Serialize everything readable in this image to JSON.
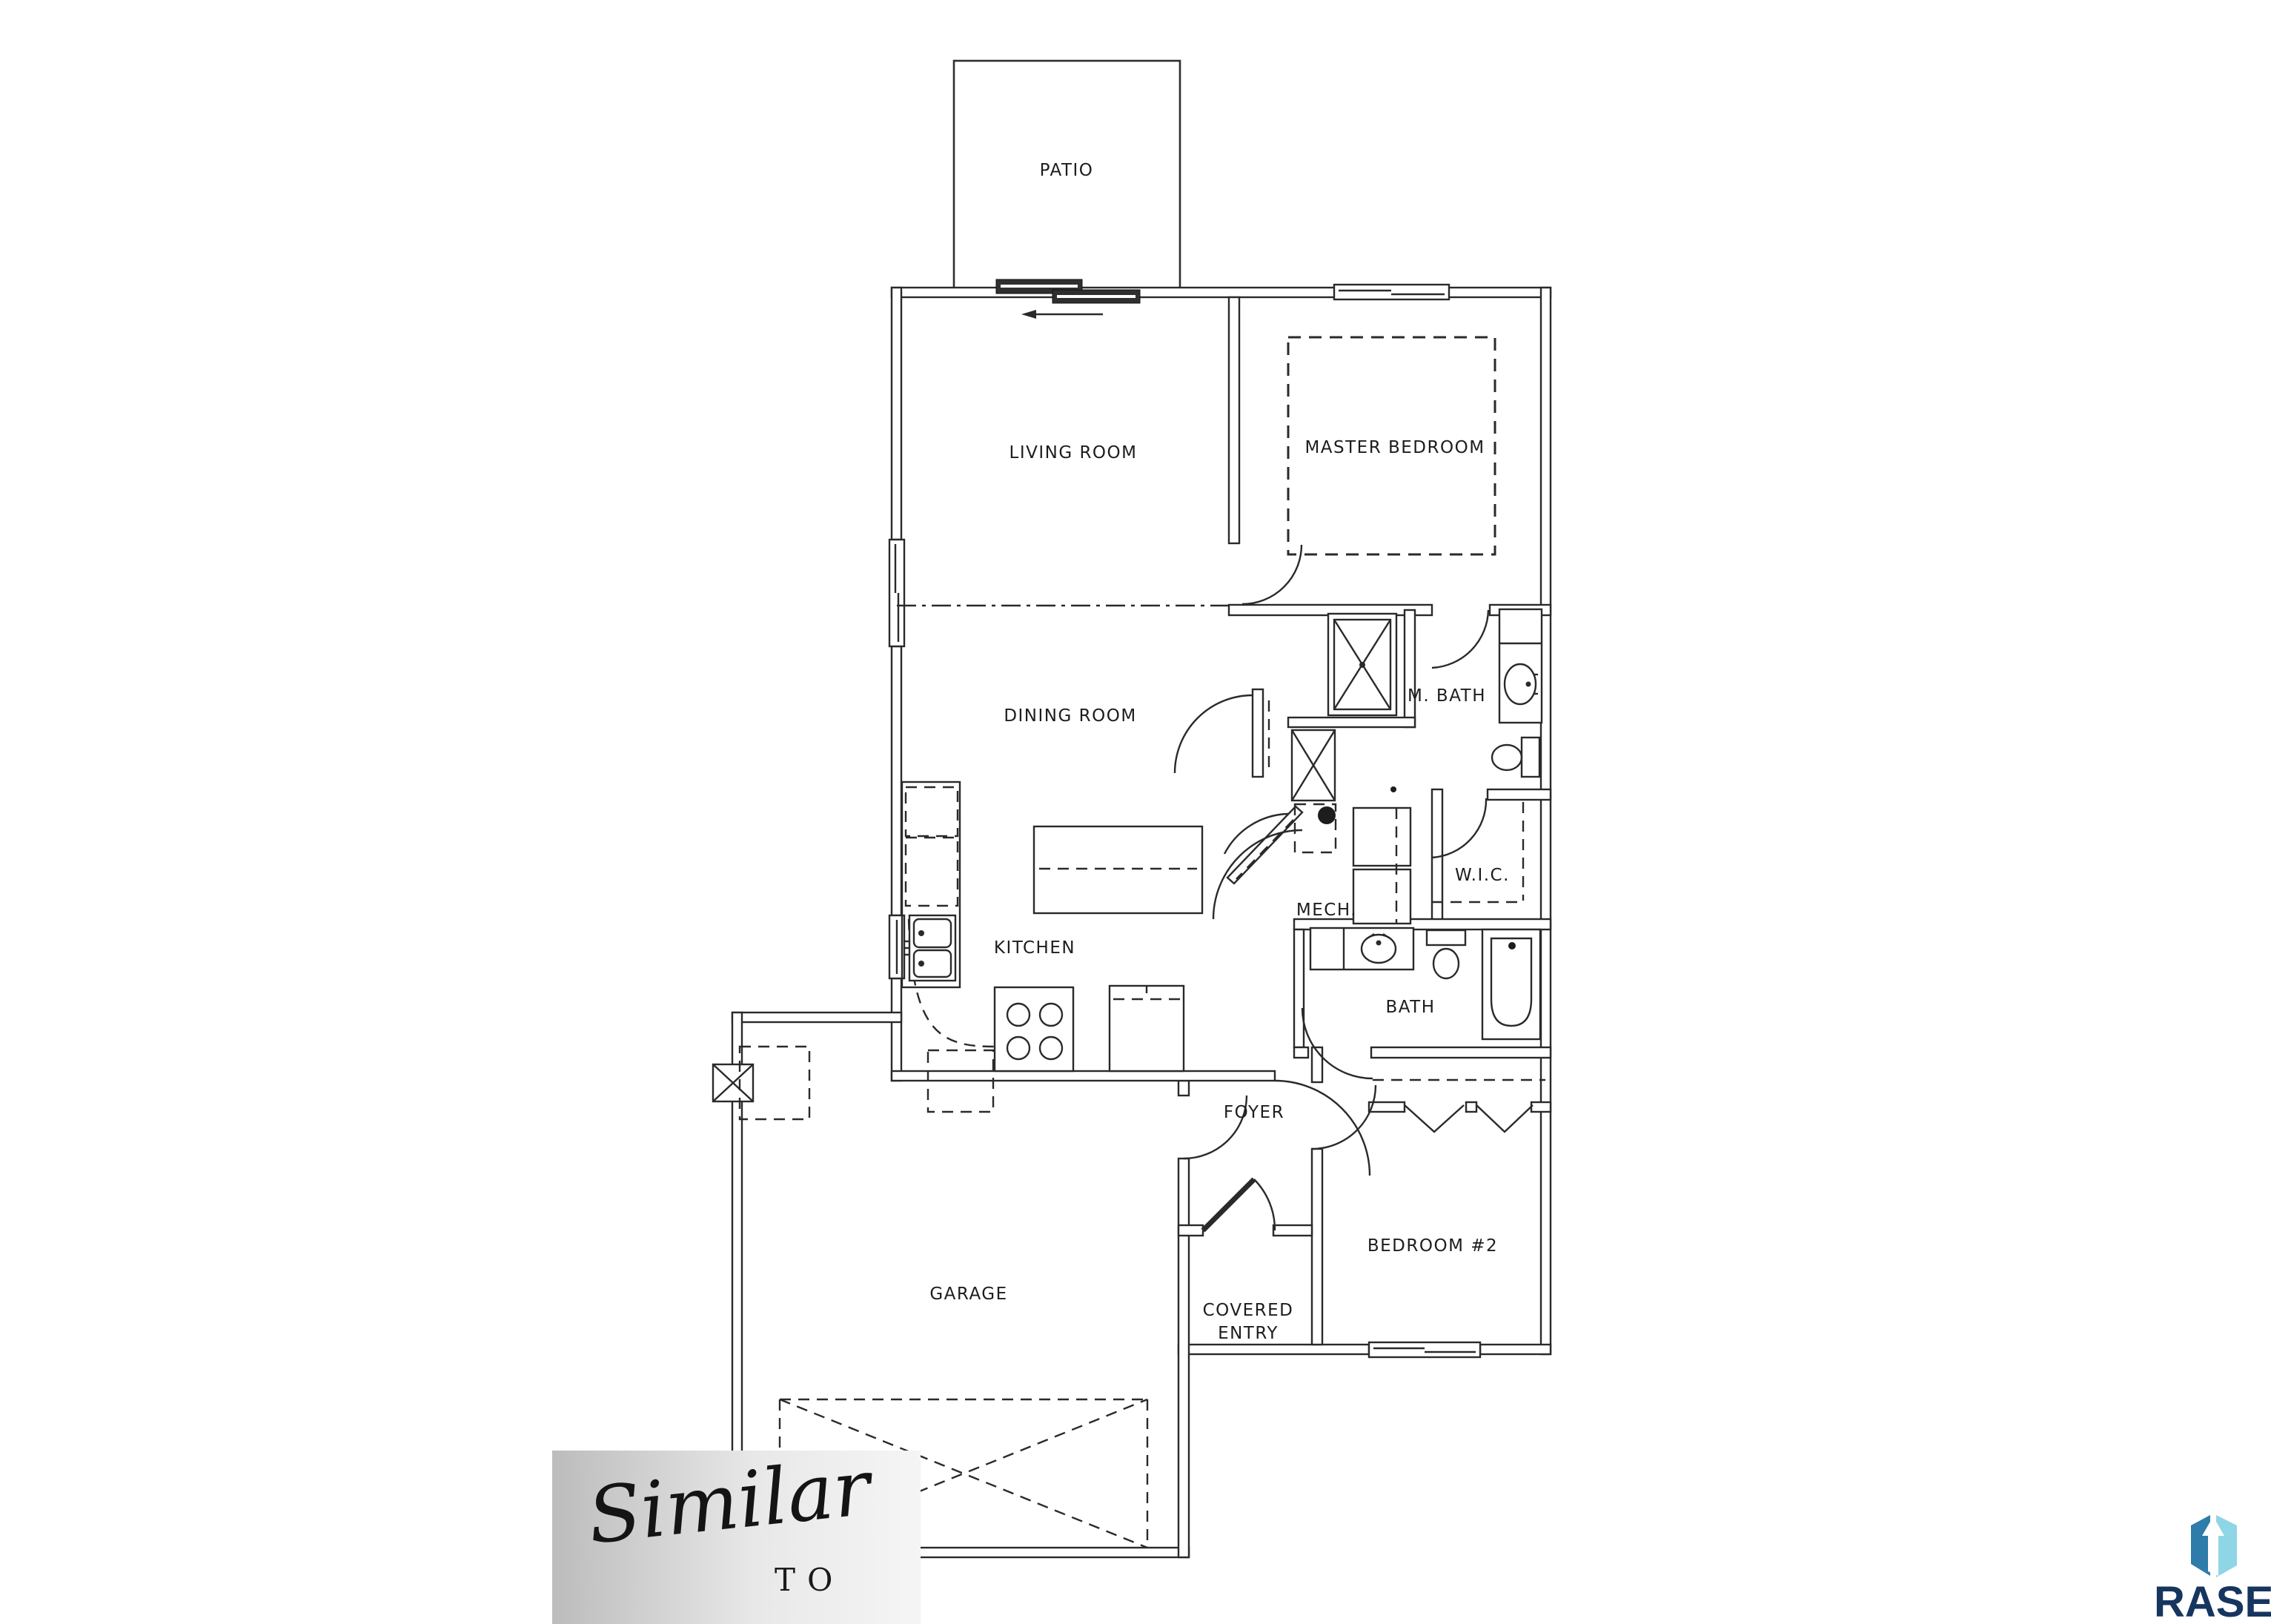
{
  "page": {
    "background": "#ffffff",
    "line_color": "#2a2a2a"
  },
  "rooms": {
    "patio": {
      "label": "PATIO"
    },
    "living": {
      "label": "LIVING ROOM"
    },
    "master": {
      "label": "MASTER BEDROOM"
    },
    "mbath": {
      "label": "M. BATH"
    },
    "dining": {
      "label": "DINING ROOM"
    },
    "wic": {
      "label": "W.I.C."
    },
    "kitchen": {
      "label": "KITCHEN"
    },
    "mech": {
      "label": "MECH."
    },
    "bath": {
      "label": "BATH"
    },
    "foyer": {
      "label": "FOYER"
    },
    "bedroom2": {
      "label": "BEDROOM #2"
    },
    "garage": {
      "label": "GARAGE"
    },
    "covered_entry": {
      "line1": "COVERED",
      "line2": "ENTRY"
    }
  },
  "icons": {
    "shower": "shower-stall-x-symbol",
    "bed": "dashed-bed-rectangle",
    "sink": "oval-lavatory",
    "toilet": "tank-and-bowl",
    "bathtub": "rounded-tub",
    "stove": "four-burner-range",
    "refrigerator": "dashed-counter-box",
    "kitchen_sink": "double-basin",
    "island": "dashed-center-island",
    "washer_dryer": "stacked-pair",
    "furnace": "x-box",
    "water_heater": "dashed-square",
    "garage_door": "dashed-x-panel",
    "bifold_closet": "chevron-doors",
    "sliding_door": "offset-dark-bars-with-arrow",
    "door": "quarter-arc-swing"
  },
  "watermark": {
    "script": "Similar",
    "sub": "TO",
    "gradient_left": "#bcbcbc",
    "gradient_right": "#f5f5f5"
  },
  "logo": {
    "text": "RASE",
    "text_color": "#16355f",
    "icon_dark": "#2d7ca9",
    "icon_light": "#8ed6e6"
  }
}
